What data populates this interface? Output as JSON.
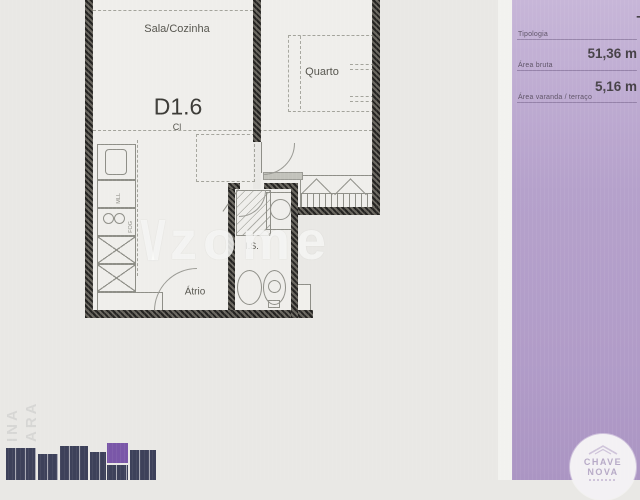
{
  "floorplan": {
    "unit_label": "D1.6",
    "rooms": {
      "living": "Sala/Cozinha",
      "bedroom": "Quarto",
      "closet": "Cl",
      "bathroom": "I.S.",
      "hall": "Átrio"
    },
    "appliances": [
      "MLL",
      "FOG"
    ],
    "watermark": {
      "mark": "\\/",
      "text": "zome"
    }
  },
  "info_panel": {
    "fields": [
      {
        "label": "Tipologia",
        "value": "T1"
      },
      {
        "label": "Área bruta",
        "value": "51,36 m"
      },
      {
        "label": "Área varanda / terraço",
        "value": "5,16 m"
      }
    ]
  },
  "agency_logo": {
    "line1": "CHAVE",
    "line2": "NOVA"
  },
  "side_text": [
    "INA",
    "ARA"
  ],
  "colors": {
    "panel_purple": "#b5a1cb",
    "paper": "#e9e8e5",
    "wall_dark": "#44423d",
    "siteplan_navy": "#3d415a",
    "siteplan_highlight": "#7a57a8",
    "logo_text": "#b6a9c6"
  }
}
